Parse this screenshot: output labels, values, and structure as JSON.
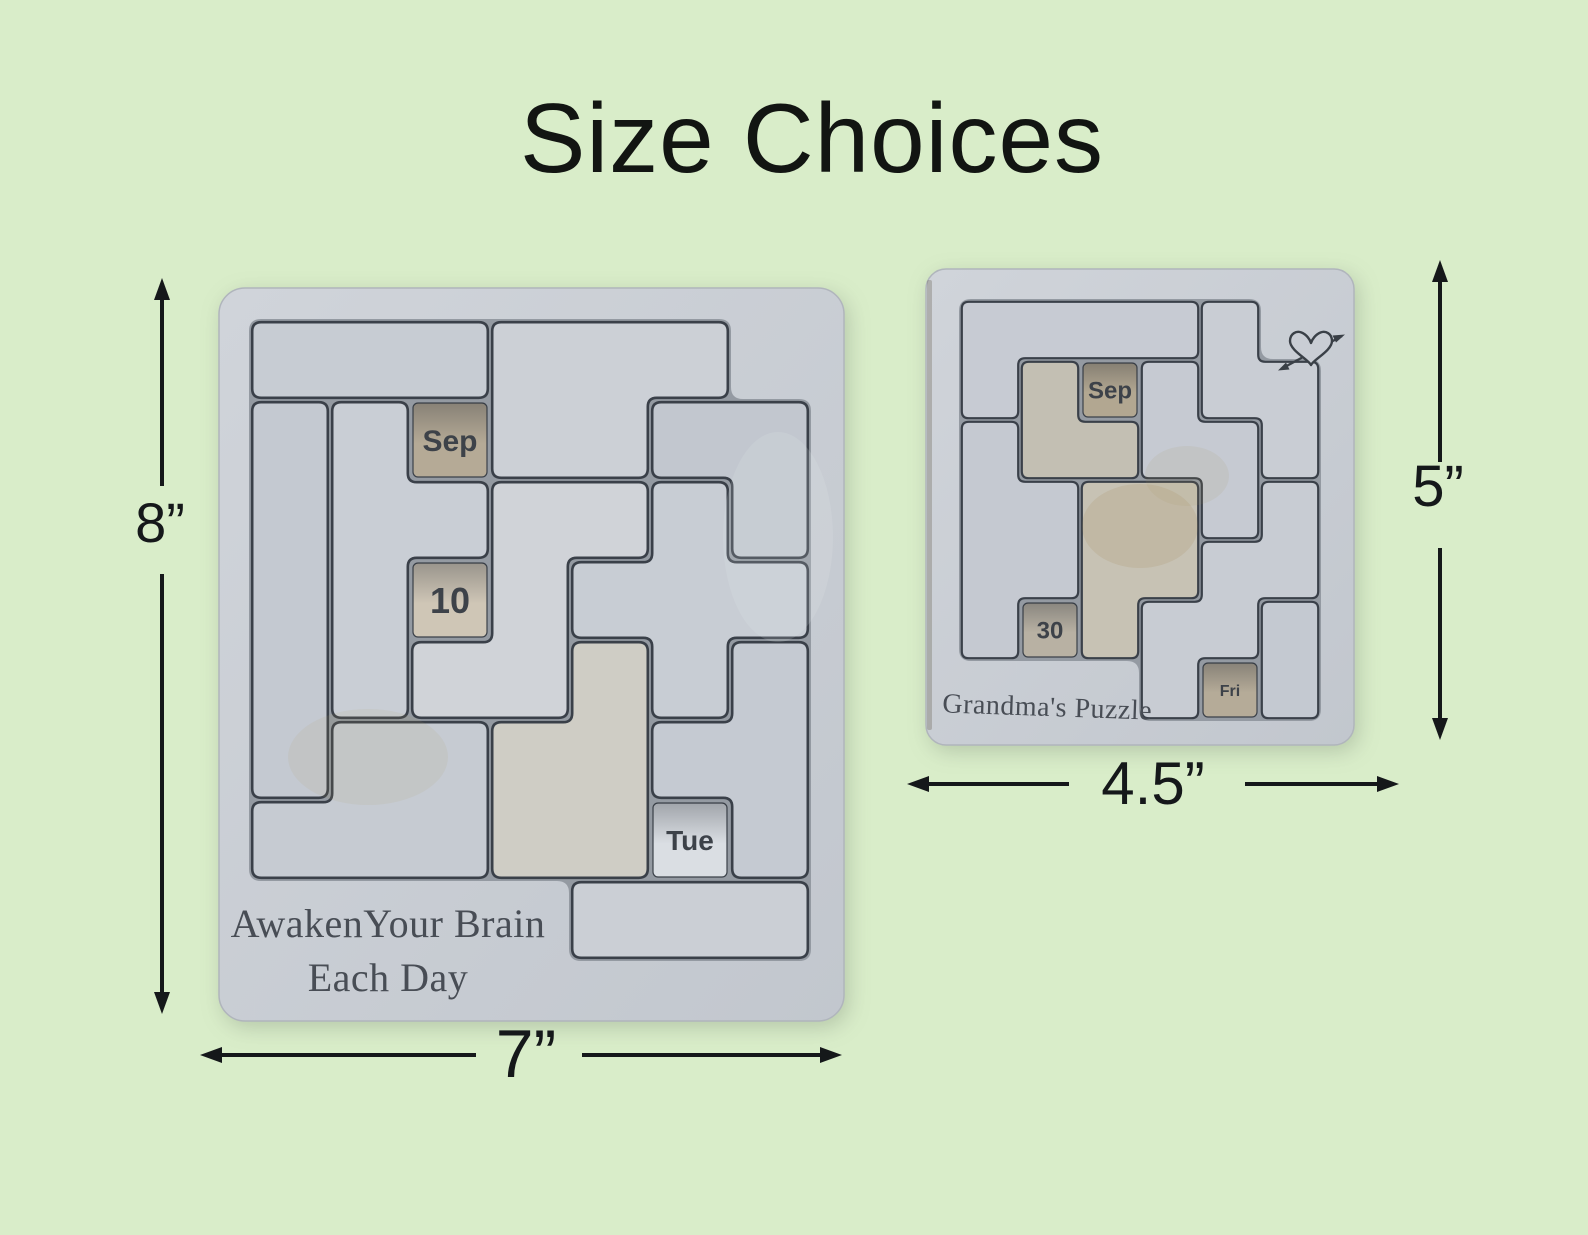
{
  "title": "Size Choices",
  "colors": {
    "background": "#d9edc9",
    "ink": "#15181a",
    "wood_light": "#d0d4da",
    "wood_dark": "#c2c7ce",
    "tray": "#949aa2",
    "seam": "#3a4049",
    "engraving": "#484d55",
    "window_text": "#3d4249"
  },
  "puzzles": {
    "large": {
      "height_label": "8”",
      "width_label": "7”",
      "engraving_lines": [
        "AwakenYour Brain",
        "Each Day"
      ],
      "windows": [
        {
          "name": "month-window-large",
          "label": "Sep",
          "cell": [
            2,
            1
          ],
          "fill": "#b5aa96",
          "size": 30,
          "bold": false
        },
        {
          "name": "date-window-large",
          "label": "10",
          "cell": [
            2,
            3
          ],
          "fill": "#cfc6b6",
          "size": 36,
          "bold": true
        },
        {
          "name": "weekday-window-large",
          "label": "Tue",
          "cell": [
            5,
            6
          ],
          "fill": "#dadee3",
          "size": 28,
          "bold": true
        }
      ],
      "pieces": [
        {
          "cells": [
            [
              0,
              0
            ],
            [
              1,
              0
            ],
            [
              2,
              0
            ]
          ],
          "fill": "#c7ccd3"
        },
        {
          "cells": [
            [
              3,
              0
            ],
            [
              4,
              0
            ],
            [
              5,
              0
            ],
            [
              3,
              1
            ],
            [
              4,
              1
            ]
          ],
          "fill": "#ccd0d6"
        },
        {
          "cells": [
            [
              5,
              1
            ],
            [
              6,
              1
            ],
            [
              6,
              2
            ]
          ],
          "fill": "#c2c7cf"
        },
        {
          "cells": [
            [
              5,
              2
            ],
            [
              4,
              3
            ],
            [
              5,
              3
            ],
            [
              6,
              3
            ],
            [
              5,
              4
            ]
          ],
          "fill": "#c8cdd4"
        },
        {
          "cells": [
            [
              0,
              1
            ],
            [
              0,
              2
            ],
            [
              0,
              3
            ],
            [
              0,
              4
            ],
            [
              0,
              5
            ]
          ],
          "fill": "#c4c9d1"
        },
        {
          "cells": [
            [
              1,
              1
            ],
            [
              1,
              2
            ],
            [
              2,
              2
            ],
            [
              1,
              3
            ],
            [
              1,
              4
            ]
          ],
          "fill": "#c9ced5"
        },
        {
          "cells": [
            [
              3,
              2
            ],
            [
              4,
              2
            ],
            [
              3,
              3
            ],
            [
              2,
              4
            ],
            [
              3,
              4
            ]
          ],
          "fill": "#d0d3d8"
        },
        {
          "cells": [
            [
              6,
              4
            ],
            [
              5,
              5
            ],
            [
              6,
              5
            ],
            [
              6,
              6
            ]
          ],
          "fill": "#c5cad2"
        },
        {
          "cells": [
            [
              4,
              4
            ],
            [
              3,
              5
            ],
            [
              4,
              5
            ],
            [
              3,
              6
            ],
            [
              4,
              6
            ]
          ],
          "fill": "#cfcdc5"
        },
        {
          "cells": [
            [
              1,
              5
            ],
            [
              2,
              5
            ],
            [
              0,
              6
            ],
            [
              1,
              6
            ],
            [
              2,
              6
            ]
          ],
          "fill": "#c6cbd2"
        },
        {
          "cells": [
            [
              4,
              7
            ],
            [
              5,
              7
            ],
            [
              6,
              7
            ]
          ],
          "fill": "#cbcfd5"
        }
      ]
    },
    "small": {
      "height_label": "5”",
      "width_label": "4.5”",
      "engraving_lines": [
        "Grandma's Puzzle"
      ],
      "corner_icon": "heart-with-arrow",
      "windows": [
        {
          "name": "month-window-small",
          "label": "Sep",
          "cell": [
            2,
            1
          ],
          "fill": "#b2a791",
          "size": 24,
          "bold": false
        },
        {
          "name": "date-window-small",
          "label": "30",
          "cell": [
            1,
            5
          ],
          "fill": "#b8b1a3",
          "size": 24,
          "bold": true
        },
        {
          "name": "weekday-window-small",
          "label": "Fri",
          "cell": [
            4,
            6
          ],
          "fill": "#b5ab98",
          "size": 16,
          "bold": true
        }
      ],
      "pieces": [
        {
          "cells": [
            [
              0,
              0
            ],
            [
              1,
              0
            ],
            [
              2,
              0
            ],
            [
              3,
              0
            ],
            [
              0,
              1
            ]
          ],
          "fill": "#c7cbd3"
        },
        {
          "cells": [
            [
              4,
              0
            ],
            [
              4,
              1
            ],
            [
              5,
              1
            ],
            [
              5,
              2
            ]
          ],
          "fill": "#c9cdd4"
        },
        {
          "cells": [
            [
              1,
              1
            ],
            [
              1,
              2
            ],
            [
              2,
              2
            ]
          ],
          "fill": "#c3bfb3"
        },
        {
          "cells": [
            [
              3,
              1
            ],
            [
              3,
              2
            ],
            [
              4,
              2
            ],
            [
              4,
              3
            ]
          ],
          "fill": "#c6cad2"
        },
        {
          "cells": [
            [
              0,
              2
            ],
            [
              0,
              3
            ],
            [
              1,
              3
            ],
            [
              0,
              4
            ],
            [
              1,
              4
            ],
            [
              0,
              5
            ]
          ],
          "fill": "#c5c9d1"
        },
        {
          "cells": [
            [
              2,
              3
            ],
            [
              3,
              3
            ],
            [
              2,
              4
            ],
            [
              3,
              4
            ],
            [
              2,
              5
            ]
          ],
          "fill": "#c7c2b4"
        },
        {
          "cells": [
            [
              5,
              3
            ],
            [
              4,
              4
            ],
            [
              5,
              4
            ],
            [
              3,
              5
            ],
            [
              4,
              5
            ],
            [
              3,
              6
            ]
          ],
          "fill": "#c8ccd3"
        },
        {
          "cells": [
            [
              5,
              5
            ],
            [
              5,
              6
            ]
          ],
          "fill": "#c4c9d1"
        }
      ]
    }
  }
}
